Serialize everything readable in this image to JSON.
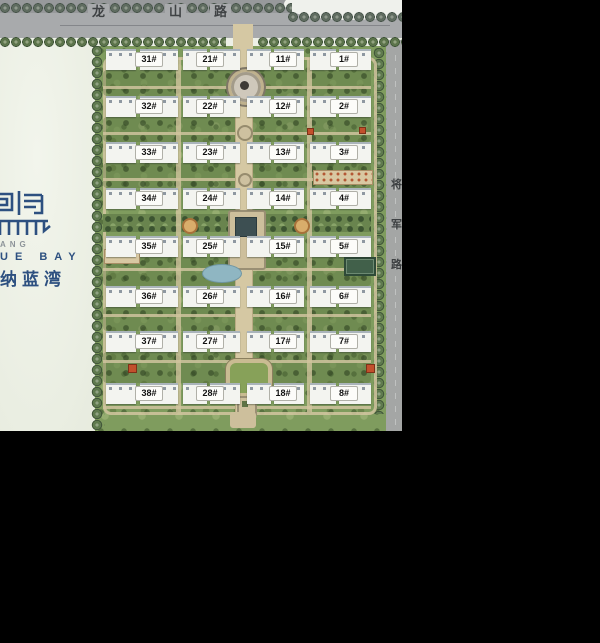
{
  "site": {
    "project_name_cn": "纳蓝湾",
    "project_name_en_partial": "UE BAY",
    "logo_small_text_partial": "ANG"
  },
  "roads": {
    "top_road_name": "龙山路",
    "top_road_chars": [
      "龙",
      "山",
      "路"
    ],
    "right_road_name": "将军路",
    "right_road_chars": [
      "将",
      "军",
      "路"
    ]
  },
  "buildings": {
    "labels": [
      "31#",
      "21#",
      "11#",
      "1#",
      "32#",
      "22#",
      "12#",
      "2#",
      "33#",
      "23#",
      "13#",
      "3#",
      "34#",
      "24#",
      "14#",
      "4#",
      "35#",
      "25#",
      "15#",
      "5#",
      "36#",
      "26#",
      "16#",
      "6#",
      "37#",
      "27#",
      "17#",
      "7#",
      "38#",
      "28#",
      "18#",
      "8#"
    ]
  },
  "colors": {
    "background": "#000000",
    "road_gray": "#a8aaac",
    "community_green": "#7f9c5e",
    "open_land": "#edf0e7",
    "path_tan": "#d5c8a3",
    "building_white": "#f3f4f0",
    "logo_blue": "#2d5080",
    "water_blue": "#8fb6c2",
    "gate_red": "#c2502c"
  }
}
